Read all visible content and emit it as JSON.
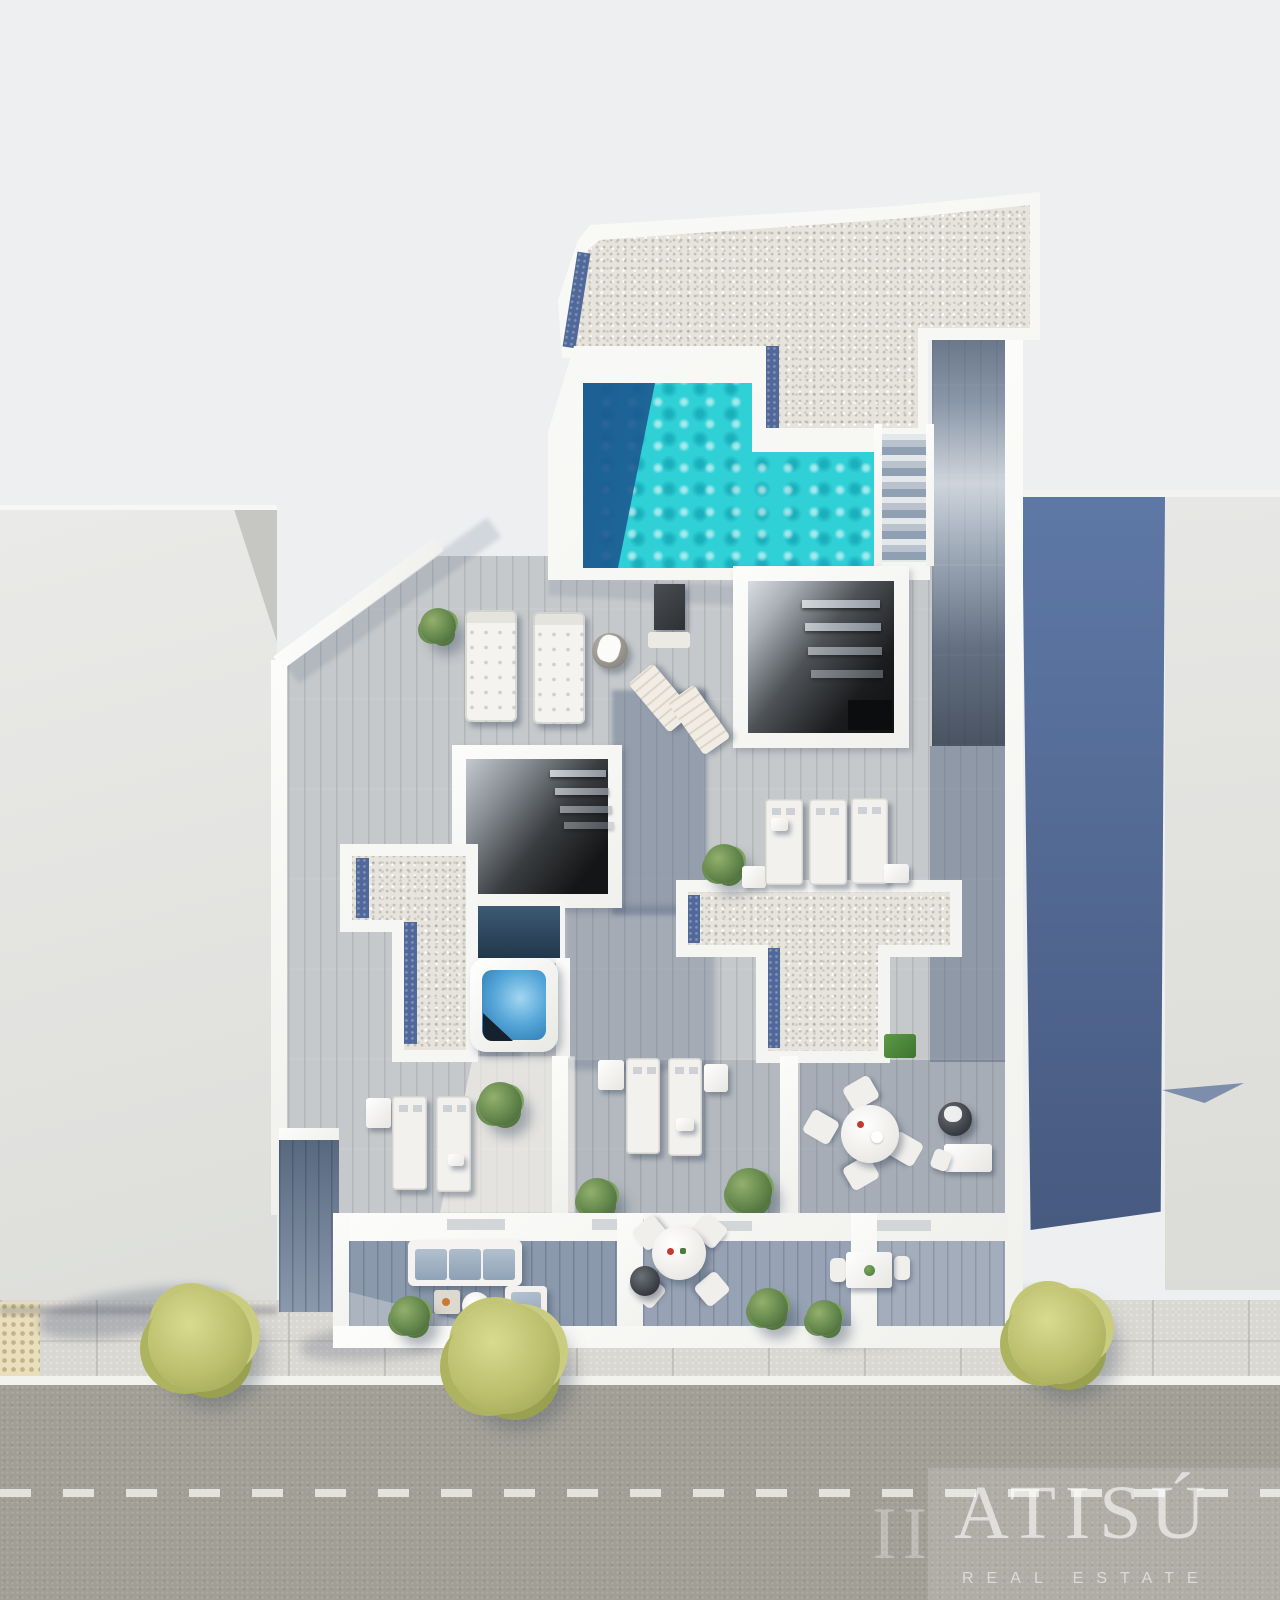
{
  "watermark": {
    "brand": "ATISÚ",
    "brand_fragment": "II",
    "tagline": "REAL ESTATE"
  },
  "scene": {
    "kind": "aerial-3d-architectural-render",
    "subject": "top-down render of a rooftop floor plan with pool, jacuzzi, gravel roofs, wood terraces, street-facing balconies and a road",
    "colors": {
      "background": "#EDEFF1",
      "pool_water": "#2FD0D6",
      "pool_shadow": "#175088",
      "jacuzzi_water": "#58A8DA",
      "gravel_roof": "#E6E4DC",
      "roof_shadow_strip": "#51699A",
      "wood_deck_light": "#C6C9CB",
      "wood_deck_shadow": "#6E7F97",
      "neighbor_roof": "#E2E3E1",
      "neighbor_wall_shadow": "#54709D",
      "sidewalk": "#DAD8D2",
      "asphalt": "#A19F95",
      "road_marking": "#E9E9E2",
      "tree_foliage": "#BCBF6C",
      "grass_patch": "#4F8F3E",
      "furniture_white": "#F3F2EF"
    }
  }
}
